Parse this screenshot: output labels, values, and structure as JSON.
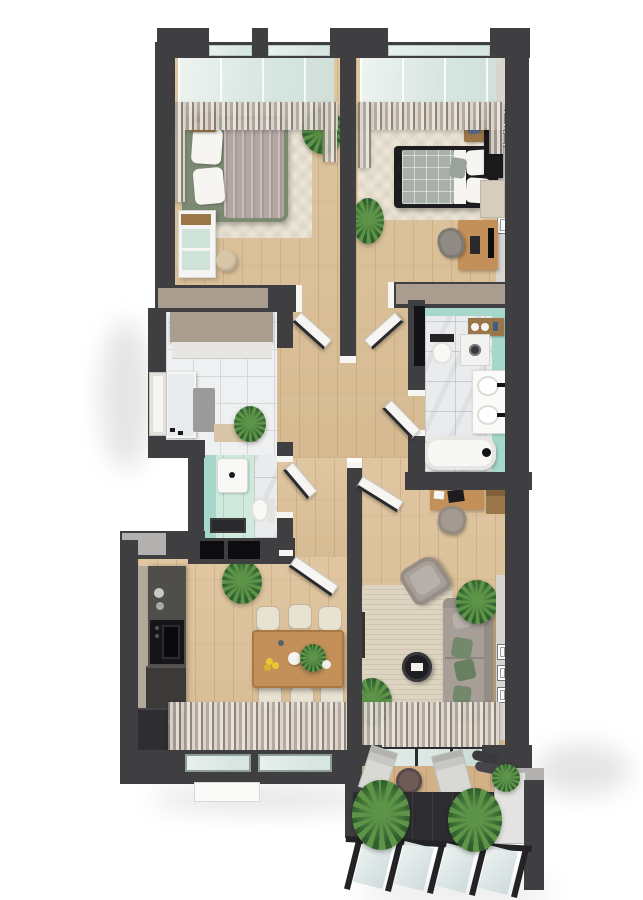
{
  "meta": {
    "description": "3D top-down render of a furnished apartment floor plan with balcony",
    "canvas_width": 643,
    "canvas_height": 900,
    "visible_text": []
  },
  "palette": {
    "bg": "#ffffff",
    "wall": "#3f3e41",
    "wall_lit": "#b2b1af",
    "wall_taupe": "#a89d8e",
    "wall_face": "#d8d5d1",
    "wood": "#dcc096",
    "tile": "#eef0f1",
    "tile_line": "#d4d8d9",
    "bath_tile": "#e9ebec",
    "teal_wall": "#a6d8ca",
    "teal_floor": "#cfe9dd",
    "glass": "#d8e6e1",
    "glass_rail": "#ccd9da",
    "rug_cream": "#ebe4d5",
    "rug_living": "#ddd4c1",
    "green_bed": "#7c8a73",
    "mauve": "#b3a6a3",
    "black_bed": "#1d1c1f",
    "check_blanket": "#a9b0a9",
    "white_soft": "#f6f5f2",
    "taupe_sofa": "#a79e98",
    "green_pillow": "#74886b",
    "oak": "#c29058",
    "oak_dark": "#9a7648",
    "cream_chair": "#e8e2d2",
    "graphite": "#504e4b",
    "graphite_dark": "#2e2d2f",
    "appliance_black": "#161618",
    "plant_dark": "#2f5f2e",
    "plant_light": "#5d9448",
    "mint_drawer": "#cfe2da",
    "mat_beige": "#d9c6a8",
    "rug_gray": "#9b9b99",
    "balcony_floor": "#2d2c2f",
    "panel_light": "#e4e3e1",
    "lemon": "#e8c832",
    "shadow": "rgba(0,0,0,0.10)"
  },
  "scene": {
    "rooms": [
      {
        "id": "bedroom-1",
        "floor": "wood",
        "furniture": [
          "double-bed-green",
          "nightstand",
          "dresser-mint",
          "pouf",
          "cream-rug",
          "plant",
          "sheer-curtains",
          "window"
        ]
      },
      {
        "id": "bedroom-2",
        "floor": "wood",
        "furniture": [
          "double-bed-black",
          "nightstand",
          "wardrobe",
          "desk",
          "desk-chair",
          "cream-cabinet",
          "cream-rug",
          "plant",
          "sheer-curtains",
          "window",
          "wall-frames"
        ],
        "wall_frames_count": 3
      },
      {
        "id": "entry-hall",
        "floor": "tile",
        "furniture": [
          "wardrobe-taupe",
          "mirror",
          "gray-rug",
          "doormat",
          "plant",
          "front-door"
        ]
      },
      {
        "id": "wc",
        "floor": "teal-tile",
        "furniture": [
          "washbasin",
          "toilet",
          "shower-mat",
          "storage-boxes"
        ]
      },
      {
        "id": "bathroom",
        "floor": "tile",
        "furniture": [
          "bathtub",
          "double-washbasin",
          "toilet",
          "washing-machine",
          "towel-shelf"
        ]
      },
      {
        "id": "hallway",
        "floor": "wood",
        "furniture": [
          "open-doors"
        ],
        "door_count": 6
      },
      {
        "id": "kitchen-dining",
        "floor": "wood",
        "furniture": [
          "kitchen-counter",
          "coffee-machine",
          "cooktop-oven",
          "tall-fridge-cabinet",
          "upper-cabinets",
          "dining-table",
          "dining-chairs",
          "lemons-bowl",
          "teapot",
          "plant",
          "sideboard",
          "sheer-curtains",
          "window"
        ],
        "dining_chairs_count": 6
      },
      {
        "id": "living-room",
        "floor": "wood",
        "furniture": [
          "sofa-taupe",
          "green-pillows",
          "armchair",
          "round-coffee-table",
          "beige-rug",
          "desk",
          "desk-chair",
          "tv-sideboard",
          "plants",
          "wall-frames",
          "sheer-curtains",
          "balcony-door"
        ],
        "wall_frames_count": 3
      },
      {
        "id": "balcony",
        "floor": "dark-tile",
        "furniture": [
          "round-table",
          "lounge-chairs",
          "plants",
          "glass-railing",
          "side-screen"
        ]
      }
    ]
  }
}
